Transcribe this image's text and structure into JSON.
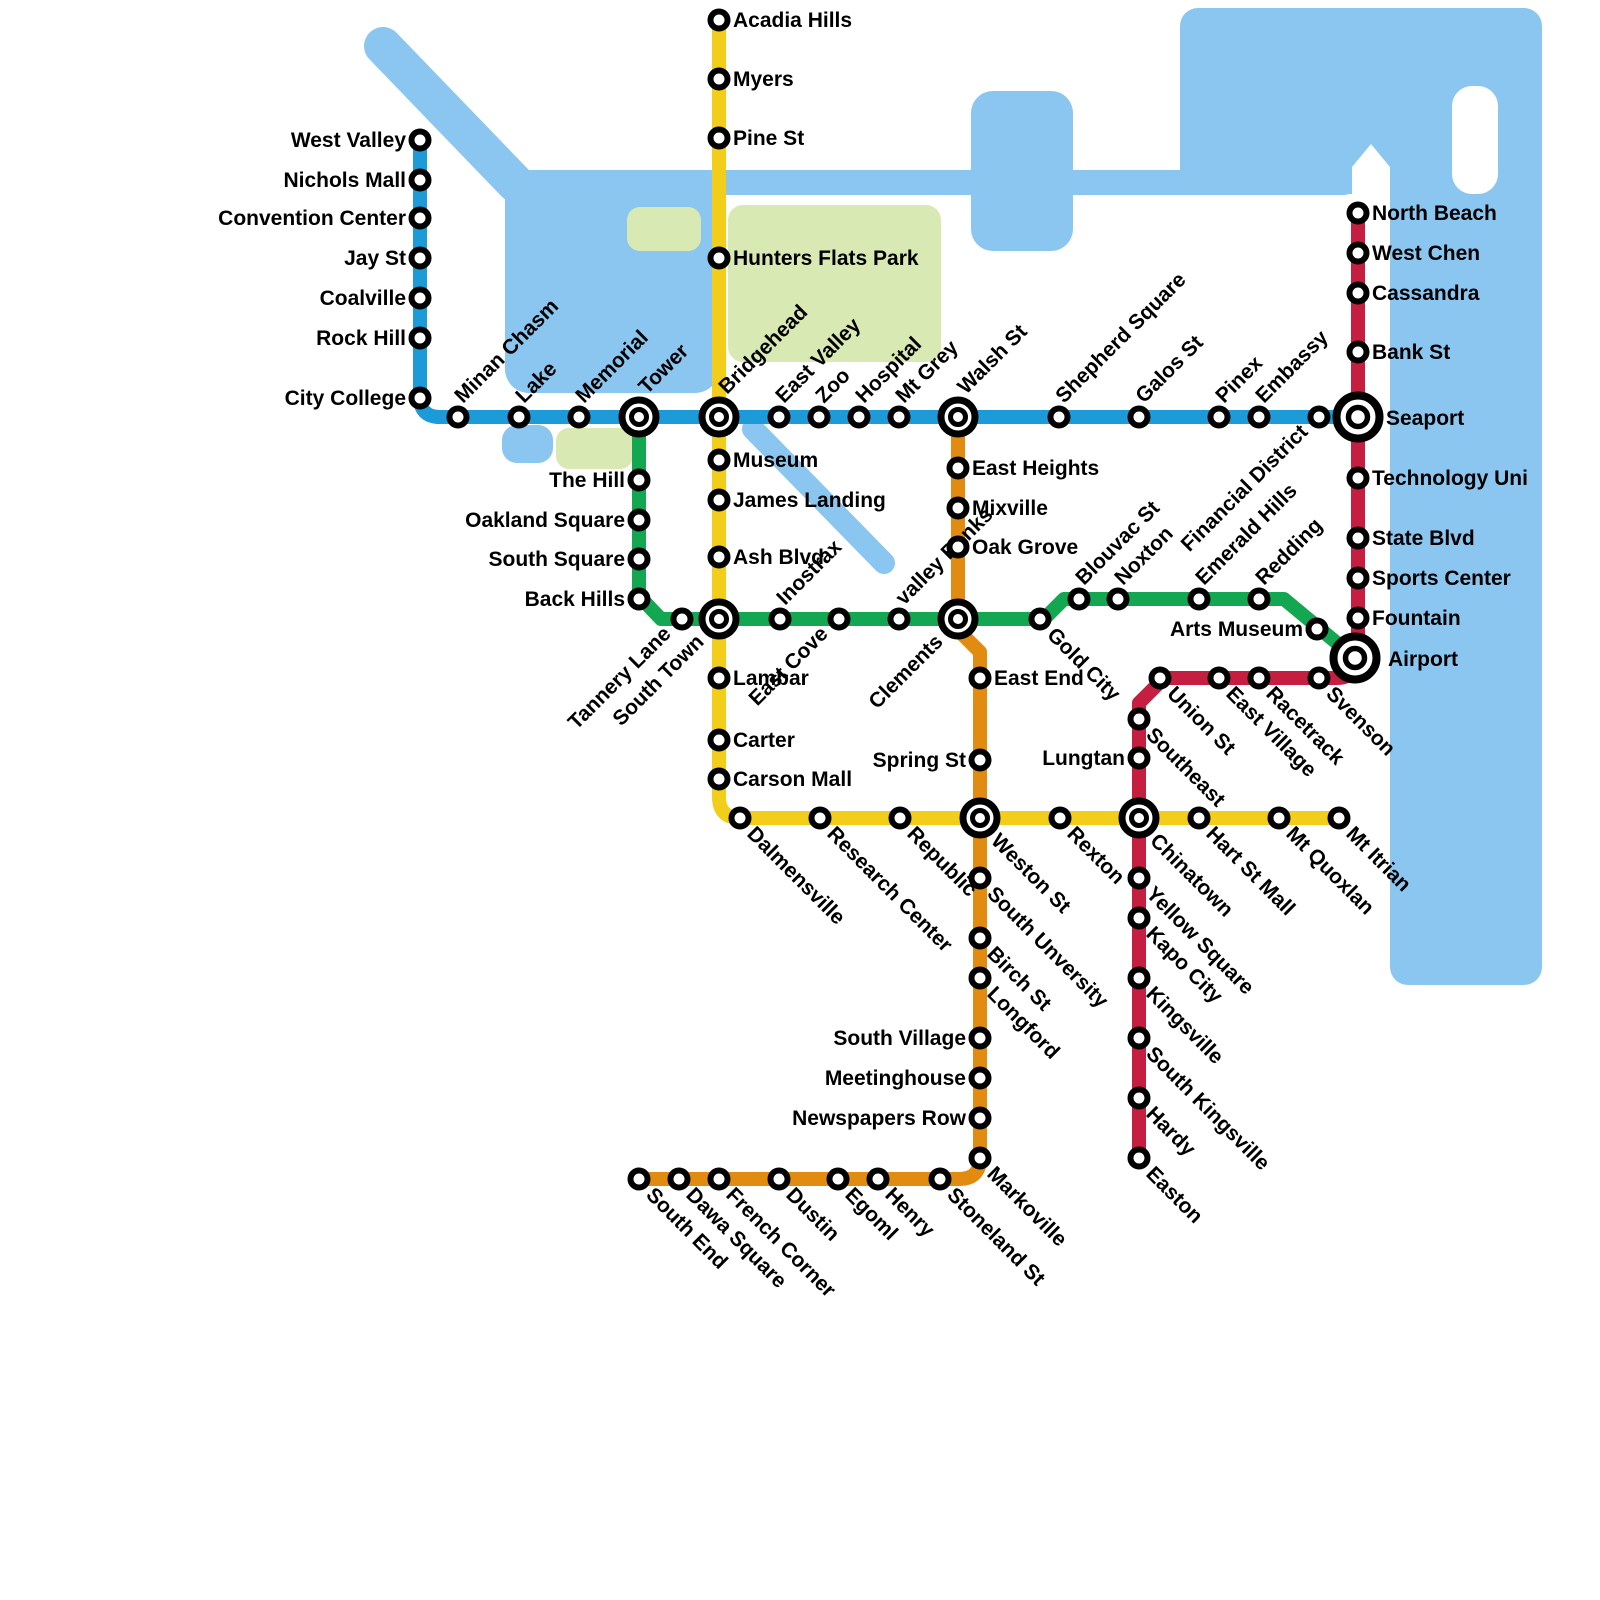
{
  "map_title": "Metro Transit Map",
  "colors": {
    "water": "#8AC6F0",
    "park": "#D9E9B3",
    "background": "#FFFFFF",
    "label": "#000000",
    "station_ring": "#000000",
    "station_fill": "#FFFFFF"
  },
  "geography": [
    {
      "name": "river-northwest",
      "kind": "line",
      "x1": 383,
      "y1": 46,
      "x2": 516,
      "y2": 184,
      "width": 38
    },
    {
      "name": "bay-west",
      "kind": "rect",
      "x": 505,
      "y": 170,
      "w": 214,
      "h": 223,
      "rx": 24
    },
    {
      "name": "river-east-band",
      "kind": "rect",
      "x": 510,
      "y": 170,
      "w": 844,
      "h": 25,
      "rx": 10
    },
    {
      "name": "lake-north",
      "kind": "rect",
      "x": 971,
      "y": 91,
      "w": 102,
      "h": 160,
      "rx": 22
    },
    {
      "name": "pond-small",
      "kind": "rect",
      "x": 502,
      "y": 425,
      "w": 51,
      "h": 38,
      "rx": 15
    },
    {
      "name": "river-diagonal-southeast",
      "kind": "line",
      "x1": 753,
      "y1": 429,
      "x2": 884,
      "y2": 563,
      "width": 22
    },
    {
      "name": "sea-north",
      "kind": "rect",
      "x": 1180,
      "y": 8,
      "w": 362,
      "h": 186,
      "rx": 18
    },
    {
      "name": "sea-east",
      "kind": "rect",
      "x": 1390,
      "y": 60,
      "w": 152,
      "h": 925,
      "rx": 18
    }
  ],
  "white_cutouts": [
    {
      "name": "peninsula-notch",
      "kind": "path",
      "d": "M1371,144 L1390,167 L1390,197 L1352,197 L1352,167 Z"
    },
    {
      "name": "island",
      "kind": "rect",
      "x": 1452,
      "y": 86,
      "w": 46,
      "h": 108,
      "rx": 20
    }
  ],
  "parks": [
    {
      "name": "hunters-flats-park-area",
      "kind": "rect",
      "x": 728,
      "y": 205,
      "w": 213,
      "h": 157,
      "rx": 15
    },
    {
      "name": "park-west",
      "kind": "rect",
      "x": 627,
      "y": 207,
      "w": 74,
      "h": 44,
      "rx": 13
    },
    {
      "name": "park-memorial-south",
      "kind": "rect",
      "x": 556,
      "y": 428,
      "w": 77,
      "h": 41,
      "rx": 13
    }
  ],
  "lines": [
    {
      "id": "blue",
      "name": "Blue Line",
      "color": "#1D9BD9",
      "width": 14,
      "path": "M420,140 L420,397 Q420,417 440,417 L1358,417",
      "stations": [
        {
          "name": "West Valley",
          "x": 420,
          "y": 140,
          "label": "l"
        },
        {
          "name": "Nichols Mall",
          "x": 420,
          "y": 180,
          "label": "l"
        },
        {
          "name": "Convention Center",
          "x": 420,
          "y": 218,
          "label": "l"
        },
        {
          "name": "Jay St",
          "x": 420,
          "y": 258,
          "label": "l"
        },
        {
          "name": "Coalville",
          "x": 420,
          "y": 298,
          "label": "l"
        },
        {
          "name": "Rock Hill",
          "x": 420,
          "y": 338,
          "label": "l"
        },
        {
          "name": "City College",
          "x": 420,
          "y": 398,
          "label": "l"
        },
        {
          "name": "Minan Chasm",
          "x": 458,
          "y": 417,
          "label": "du"
        },
        {
          "name": "Lake",
          "x": 519,
          "y": 417,
          "label": "du"
        },
        {
          "name": "Memorial",
          "x": 579,
          "y": 417,
          "label": "du"
        },
        {
          "name": "East Valley",
          "x": 779,
          "y": 417,
          "label": "du"
        },
        {
          "name": "Zoo",
          "x": 819,
          "y": 417,
          "label": "du"
        },
        {
          "name": "Hospital",
          "x": 859,
          "y": 417,
          "label": "du"
        },
        {
          "name": "Mt Grey",
          "x": 899,
          "y": 417,
          "label": "du"
        },
        {
          "name": "Shepherd Square",
          "x": 1059,
          "y": 417,
          "label": "du"
        },
        {
          "name": "Galos St",
          "x": 1139,
          "y": 417,
          "label": "du"
        },
        {
          "name": "Pinex",
          "x": 1219,
          "y": 417,
          "label": "du"
        },
        {
          "name": "Embassy",
          "x": 1259,
          "y": 417,
          "label": "du"
        },
        {
          "name": "Financial District",
          "x": 1319,
          "y": 417,
          "label": "due"
        }
      ]
    },
    {
      "id": "yellow",
      "name": "Yellow Line",
      "color": "#F2CE1B",
      "width": 14,
      "path": "M719,20 L719,797 Q719,818 740,818 L1339,818",
      "stations": [
        {
          "name": "Acadia Hills",
          "x": 719,
          "y": 20,
          "label": "r"
        },
        {
          "name": "Myers",
          "x": 719,
          "y": 79,
          "label": "r"
        },
        {
          "name": "Pine St",
          "x": 719,
          "y": 138,
          "label": "r"
        },
        {
          "name": "Hunters Flats Park",
          "x": 719,
          "y": 258,
          "label": "r"
        },
        {
          "name": "Museum",
          "x": 719,
          "y": 460,
          "label": "r"
        },
        {
          "name": "James Landing",
          "x": 719,
          "y": 500,
          "label": "r"
        },
        {
          "name": "Ash Blvd",
          "x": 719,
          "y": 557,
          "label": "r"
        },
        {
          "name": "Lambar",
          "x": 719,
          "y": 678,
          "label": "r"
        },
        {
          "name": "Carter",
          "x": 719,
          "y": 740,
          "label": "r"
        },
        {
          "name": "Carson Mall",
          "x": 719,
          "y": 779,
          "label": "r"
        },
        {
          "name": "Dalmensville",
          "x": 740,
          "y": 818,
          "label": "dd"
        },
        {
          "name": "Research Center",
          "x": 820,
          "y": 818,
          "label": "dd"
        },
        {
          "name": "Republic",
          "x": 900,
          "y": 818,
          "label": "dd"
        },
        {
          "name": "Rexton",
          "x": 1060,
          "y": 818,
          "label": "dd"
        },
        {
          "name": "Hart St Mall",
          "x": 1199,
          "y": 818,
          "label": "dd"
        },
        {
          "name": "Mt Quoxlan",
          "x": 1279,
          "y": 818,
          "label": "dd"
        },
        {
          "name": "Mt Itrian",
          "x": 1339,
          "y": 818,
          "label": "dd"
        }
      ]
    },
    {
      "id": "green",
      "name": "Green Line",
      "color": "#12A750",
      "width": 14,
      "path": "M639,417 L639,596 L661,619 L1044,619 L1064,599 L1284,599 L1355,658",
      "stations": [
        {
          "name": "The Hill",
          "x": 639,
          "y": 480,
          "label": "l"
        },
        {
          "name": "Oakland Square",
          "x": 639,
          "y": 520,
          "label": "l"
        },
        {
          "name": "South Square",
          "x": 639,
          "y": 559,
          "label": "l"
        },
        {
          "name": "Back Hills",
          "x": 639,
          "y": 599,
          "label": "l"
        },
        {
          "name": "Tannery Lane",
          "x": 682,
          "y": 619,
          "label": "due"
        },
        {
          "name": "Inostrax",
          "x": 780,
          "y": 619,
          "label": "du"
        },
        {
          "name": "East Cove",
          "x": 839,
          "y": 619,
          "label": "due"
        },
        {
          "name": "valley Banks",
          "x": 899,
          "y": 619,
          "label": "du"
        },
        {
          "name": "Gold City",
          "x": 1040,
          "y": 619,
          "label": "dd"
        },
        {
          "name": "Blouvac St",
          "x": 1079,
          "y": 599,
          "label": "du"
        },
        {
          "name": "Noxton",
          "x": 1118,
          "y": 599,
          "label": "du"
        },
        {
          "name": "Emerald Hills",
          "x": 1199,
          "y": 599,
          "label": "du"
        },
        {
          "name": "Redding",
          "x": 1259,
          "y": 599,
          "label": "du"
        },
        {
          "name": "Arts Museum",
          "x": 1317,
          "y": 629,
          "label": "l"
        }
      ]
    },
    {
      "id": "orange",
      "name": "Orange Line",
      "color": "#E28B11",
      "width": 14,
      "path": "M958,417 L958,630 L980,652 L980,1158 Q980,1179 959,1179 L639,1179",
      "stations": [
        {
          "name": "East Heights",
          "x": 958,
          "y": 468,
          "label": "r"
        },
        {
          "name": "Mixville",
          "x": 958,
          "y": 508,
          "label": "r"
        },
        {
          "name": "Oak Grove",
          "x": 958,
          "y": 547,
          "label": "r"
        },
        {
          "name": "East End",
          "x": 980,
          "y": 678,
          "label": "r"
        },
        {
          "name": "Spring St",
          "x": 980,
          "y": 760,
          "label": "l"
        },
        {
          "name": "South Unversity",
          "x": 980,
          "y": 878,
          "label": "dd"
        },
        {
          "name": "Birch St",
          "x": 980,
          "y": 938,
          "label": "dd"
        },
        {
          "name": "Longford",
          "x": 980,
          "y": 978,
          "label": "dd"
        },
        {
          "name": "South Village",
          "x": 980,
          "y": 1038,
          "label": "l"
        },
        {
          "name": "Meetinghouse",
          "x": 980,
          "y": 1078,
          "label": "l"
        },
        {
          "name": "Newspapers Row",
          "x": 980,
          "y": 1118,
          "label": "l"
        },
        {
          "name": "Markoville",
          "x": 980,
          "y": 1158,
          "label": "dd"
        },
        {
          "name": "Stoneland St",
          "x": 940,
          "y": 1179,
          "label": "dd"
        },
        {
          "name": "Henry",
          "x": 878,
          "y": 1179,
          "label": "dd"
        },
        {
          "name": "Egoml",
          "x": 838,
          "y": 1179,
          "label": "dd"
        },
        {
          "name": "Dustin",
          "x": 779,
          "y": 1179,
          "label": "dd"
        },
        {
          "name": "French Corner",
          "x": 719,
          "y": 1179,
          "label": "dd"
        },
        {
          "name": "Dawa Square",
          "x": 679,
          "y": 1179,
          "label": "dd"
        },
        {
          "name": "South End",
          "x": 639,
          "y": 1179,
          "label": "dd"
        }
      ]
    },
    {
      "id": "red",
      "name": "Red Line",
      "color": "#C51E41",
      "width": 14,
      "path": "M1358,206 L1358,656 Q1358,678 1336,678 L1164,678 L1139,703 L1139,1162",
      "stations": [
        {
          "name": "North Beach",
          "x": 1358,
          "y": 213,
          "label": "r"
        },
        {
          "name": "West Chen",
          "x": 1358,
          "y": 253,
          "label": "r"
        },
        {
          "name": "Cassandra",
          "x": 1358,
          "y": 293,
          "label": "r"
        },
        {
          "name": "Bank St",
          "x": 1358,
          "y": 352,
          "label": "r"
        },
        {
          "name": "Technology Uni",
          "x": 1358,
          "y": 478,
          "label": "r"
        },
        {
          "name": "State Blvd",
          "x": 1358,
          "y": 538,
          "label": "r"
        },
        {
          "name": "Sports Center",
          "x": 1358,
          "y": 578,
          "label": "r"
        },
        {
          "name": "Fountain",
          "x": 1358,
          "y": 618,
          "label": "r"
        },
        {
          "name": "Svenson",
          "x": 1319,
          "y": 678,
          "label": "dd"
        },
        {
          "name": "Racetrack",
          "x": 1259,
          "y": 678,
          "label": "dd"
        },
        {
          "name": "East Village",
          "x": 1219,
          "y": 678,
          "label": "dd"
        },
        {
          "name": "Union St",
          "x": 1160,
          "y": 678,
          "label": "dd"
        },
        {
          "name": "Southeast",
          "x": 1139,
          "y": 719,
          "label": "dd"
        },
        {
          "name": "Lungtan",
          "x": 1139,
          "y": 758,
          "label": "l"
        },
        {
          "name": "Yellow Square",
          "x": 1139,
          "y": 878,
          "label": "dd"
        },
        {
          "name": "Kapo City",
          "x": 1139,
          "y": 918,
          "label": "dd"
        },
        {
          "name": "Kingsville",
          "x": 1139,
          "y": 978,
          "label": "dd"
        },
        {
          "name": "South Kingsville",
          "x": 1139,
          "y": 1038,
          "label": "dd"
        },
        {
          "name": "Hardy",
          "x": 1139,
          "y": 1098,
          "label": "dd"
        },
        {
          "name": "Easton",
          "x": 1139,
          "y": 1158,
          "label": "dd"
        }
      ]
    }
  ],
  "interchanges": [
    {
      "name": "Tower",
      "x": 639,
      "y": 417,
      "size": "m",
      "label": "du",
      "dx": 8,
      "dy": -22
    },
    {
      "name": "Bridgehead",
      "x": 719,
      "y": 417,
      "size": "m",
      "label": "du",
      "dx": 8,
      "dy": -22
    },
    {
      "name": "Walsh St",
      "x": 958,
      "y": 417,
      "size": "m",
      "label": "du",
      "dx": 8,
      "dy": -22
    },
    {
      "name": "Seaport",
      "x": 1358,
      "y": 417,
      "size": "xl",
      "label": "r",
      "dx": 28,
      "dy": 8
    },
    {
      "name": "South Town",
      "x": 719,
      "y": 619,
      "size": "m",
      "label": "due",
      "dx": -14,
      "dy": 24
    },
    {
      "name": "Clements",
      "x": 958,
      "y": 619,
      "size": "m",
      "label": "due",
      "dx": -14,
      "dy": 24
    },
    {
      "name": "Weston St",
      "x": 980,
      "y": 818,
      "size": "m",
      "label": "dd",
      "dx": 10,
      "dy": 24
    },
    {
      "name": "Chinatown",
      "x": 1139,
      "y": 818,
      "size": "m",
      "label": "dd",
      "dx": 10,
      "dy": 24
    },
    {
      "name": "Airport",
      "x": 1355,
      "y": 658,
      "size": "xl",
      "label": "r",
      "dx": 33,
      "dy": 8
    }
  ]
}
